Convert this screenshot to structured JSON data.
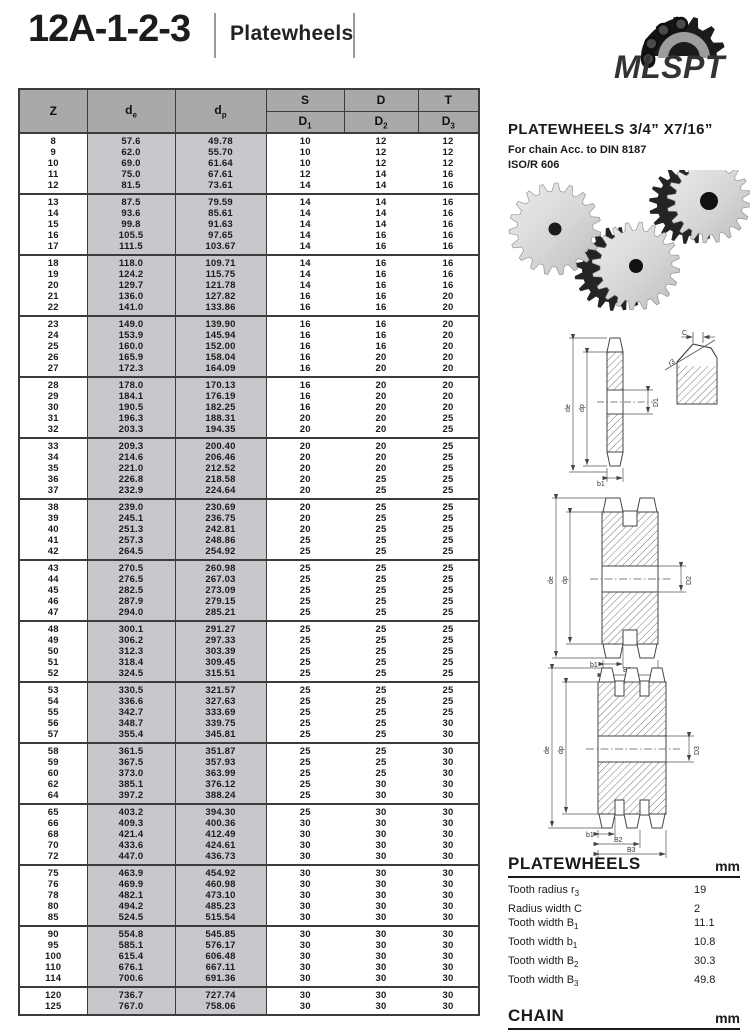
{
  "page": {
    "title": "12A-1-2-3",
    "subtitle": "Platewheels"
  },
  "logo": {
    "text": "MLSPT",
    "color": "#F08233"
  },
  "table": {
    "headers": {
      "z": "Z",
      "de_main": "d",
      "de_sub": "e",
      "dp_main": "d",
      "dp_sub": "p",
      "s": "S",
      "d": "D",
      "t": "T",
      "d1_main": "D",
      "d1_sub": "1",
      "d2_main": "D",
      "d2_sub": "2",
      "d3_main": "D",
      "d3_sub": "3"
    },
    "groups": [
      [
        [
          "8",
          "57.6",
          "49.78",
          "10",
          "12",
          "12"
        ],
        [
          "9",
          "62.0",
          "55.70",
          "10",
          "12",
          "12"
        ],
        [
          "10",
          "69.0",
          "61.64",
          "10",
          "12",
          "12"
        ],
        [
          "11",
          "75.0",
          "67.61",
          "12",
          "14",
          "16"
        ],
        [
          "12",
          "81.5",
          "73.61",
          "14",
          "14",
          "16"
        ]
      ],
      [
        [
          "13",
          "87.5",
          "79.59",
          "14",
          "14",
          "16"
        ],
        [
          "14",
          "93.6",
          "85.61",
          "14",
          "14",
          "16"
        ],
        [
          "15",
          "99.8",
          "91.63",
          "14",
          "14",
          "16"
        ],
        [
          "16",
          "105.5",
          "97.65",
          "14",
          "16",
          "16"
        ],
        [
          "17",
          "111.5",
          "103.67",
          "14",
          "16",
          "16"
        ]
      ],
      [
        [
          "18",
          "118.0",
          "109.71",
          "14",
          "16",
          "16"
        ],
        [
          "19",
          "124.2",
          "115.75",
          "14",
          "16",
          "16"
        ],
        [
          "20",
          "129.7",
          "121.78",
          "14",
          "16",
          "16"
        ],
        [
          "21",
          "136.0",
          "127.82",
          "16",
          "16",
          "20"
        ],
        [
          "22",
          "141.0",
          "133.86",
          "16",
          "16",
          "20"
        ]
      ],
      [
        [
          "23",
          "149.0",
          "139.90",
          "16",
          "16",
          "20"
        ],
        [
          "24",
          "153.9",
          "145.94",
          "16",
          "16",
          "20"
        ],
        [
          "25",
          "160.0",
          "152.00",
          "16",
          "16",
          "20"
        ],
        [
          "26",
          "165.9",
          "158.04",
          "16",
          "20",
          "20"
        ],
        [
          "27",
          "172.3",
          "164.09",
          "16",
          "20",
          "20"
        ]
      ],
      [
        [
          "28",
          "178.0",
          "170.13",
          "16",
          "20",
          "20"
        ],
        [
          "29",
          "184.1",
          "176.19",
          "16",
          "20",
          "20"
        ],
        [
          "30",
          "190.5",
          "182.25",
          "16",
          "20",
          "20"
        ],
        [
          "31",
          "196.3",
          "188.31",
          "20",
          "20",
          "25"
        ],
        [
          "32",
          "203.3",
          "194.35",
          "20",
          "20",
          "25"
        ]
      ],
      [
        [
          "33",
          "209.3",
          "200.40",
          "20",
          "20",
          "25"
        ],
        [
          "34",
          "214.6",
          "206.46",
          "20",
          "20",
          "25"
        ],
        [
          "35",
          "221.0",
          "212.52",
          "20",
          "20",
          "25"
        ],
        [
          "36",
          "226.8",
          "218.58",
          "20",
          "25",
          "25"
        ],
        [
          "37",
          "232.9",
          "224.64",
          "20",
          "25",
          "25"
        ]
      ],
      [
        [
          "38",
          "239.0",
          "230.69",
          "20",
          "25",
          "25"
        ],
        [
          "39",
          "245.1",
          "236.75",
          "20",
          "25",
          "25"
        ],
        [
          "40",
          "251.3",
          "242.81",
          "20",
          "25",
          "25"
        ],
        [
          "41",
          "257.3",
          "248.86",
          "25",
          "25",
          "25"
        ],
        [
          "42",
          "264.5",
          "254.92",
          "25",
          "25",
          "25"
        ]
      ],
      [
        [
          "43",
          "270.5",
          "260.98",
          "25",
          "25",
          "25"
        ],
        [
          "44",
          "276.5",
          "267.03",
          "25",
          "25",
          "25"
        ],
        [
          "45",
          "282.5",
          "273.09",
          "25",
          "25",
          "25"
        ],
        [
          "46",
          "287.9",
          "279.15",
          "25",
          "25",
          "25"
        ],
        [
          "47",
          "294.0",
          "285.21",
          "25",
          "25",
          "25"
        ]
      ],
      [
        [
          "48",
          "300.1",
          "291.27",
          "25",
          "25",
          "25"
        ],
        [
          "49",
          "306.2",
          "297.33",
          "25",
          "25",
          "25"
        ],
        [
          "50",
          "312.3",
          "303.39",
          "25",
          "25",
          "25"
        ],
        [
          "51",
          "318.4",
          "309.45",
          "25",
          "25",
          "25"
        ],
        [
          "52",
          "324.5",
          "315.51",
          "25",
          "25",
          "25"
        ]
      ],
      [
        [
          "53",
          "330.5",
          "321.57",
          "25",
          "25",
          "25"
        ],
        [
          "54",
          "336.6",
          "327.63",
          "25",
          "25",
          "25"
        ],
        [
          "55",
          "342.7",
          "333.69",
          "25",
          "25",
          "25"
        ],
        [
          "56",
          "348.7",
          "339.75",
          "25",
          "25",
          "30"
        ],
        [
          "57",
          "355.4",
          "345.81",
          "25",
          "25",
          "30"
        ]
      ],
      [
        [
          "58",
          "361.5",
          "351.87",
          "25",
          "25",
          "30"
        ],
        [
          "59",
          "367.5",
          "357.93",
          "25",
          "25",
          "30"
        ],
        [
          "60",
          "373.0",
          "363.99",
          "25",
          "25",
          "30"
        ],
        [
          "62",
          "385.1",
          "376.12",
          "25",
          "30",
          "30"
        ],
        [
          "64",
          "397.2",
          "388.24",
          "25",
          "30",
          "30"
        ]
      ],
      [
        [
          "65",
          "403.2",
          "394.30",
          "25",
          "30",
          "30"
        ],
        [
          "66",
          "409.3",
          "400.36",
          "30",
          "30",
          "30"
        ],
        [
          "68",
          "421.4",
          "412.49",
          "30",
          "30",
          "30"
        ],
        [
          "70",
          "433.6",
          "424.61",
          "30",
          "30",
          "30"
        ],
        [
          "72",
          "447.0",
          "436.73",
          "30",
          "30",
          "30"
        ]
      ],
      [
        [
          "75",
          "463.9",
          "454.92",
          "30",
          "30",
          "30"
        ],
        [
          "76",
          "469.9",
          "460.98",
          "30",
          "30",
          "30"
        ],
        [
          "78",
          "482.1",
          "473.10",
          "30",
          "30",
          "30"
        ],
        [
          "80",
          "494.2",
          "485.23",
          "30",
          "30",
          "30"
        ],
        [
          "85",
          "524.5",
          "515.54",
          "30",
          "30",
          "30"
        ]
      ],
      [
        [
          "90",
          "554.8",
          "545.85",
          "30",
          "30",
          "30"
        ],
        [
          "95",
          "585.1",
          "576.17",
          "30",
          "30",
          "30"
        ],
        [
          "100",
          "615.4",
          "606.48",
          "30",
          "30",
          "30"
        ],
        [
          "110",
          "676.1",
          "667.11",
          "30",
          "30",
          "30"
        ],
        [
          "114",
          "700.6",
          "691.36",
          "30",
          "30",
          "30"
        ]
      ],
      [
        [
          "120",
          "736.7",
          "727.74",
          "30",
          "30",
          "30"
        ],
        [
          "125",
          "767.0",
          "758.06",
          "30",
          "30",
          "30"
        ]
      ]
    ]
  },
  "right": {
    "heading": "PLATEWHEELS 3/4” X7/16”",
    "sub1": "For chain Acc. to DIN 8187",
    "sub2": "ISO/R 606",
    "diagrams": {
      "single": {
        "de": "de",
        "dp": "dp",
        "bore": "D1",
        "b1": "b1",
        "c": "C",
        "r3": "r3"
      },
      "duplex": {
        "de": "de",
        "dp": "dp",
        "bore": "D2",
        "b1": "b1",
        "b2": "B2"
      },
      "triplex": {
        "de": "de",
        "dp": "dp",
        "bore": "D3",
        "b1": "b1",
        "b2": "B2",
        "b3": "B3"
      }
    },
    "specs": {
      "platewheels": {
        "title": "PLATEWHEELS",
        "unit": "mm",
        "items": [
          {
            "label": "Tooth radius r",
            "sub": "3",
            "value": "19"
          },
          {
            "label": "Radius width C",
            "sub": "",
            "value": "2"
          },
          {
            "label": "Tooth width B",
            "sub": "1",
            "value": "11.1"
          },
          {
            "label": "Tooth width b",
            "sub": "1",
            "value": "10.8"
          },
          {
            "label": "Tooth width B",
            "sub": "2",
            "value": "30.3"
          },
          {
            "label": "Tooth width B",
            "sub": "3",
            "value": "49.8"
          }
        ]
      },
      "chain": {
        "title": "CHAIN",
        "unit": "mm",
        "items": [
          {
            "label": "Pitch",
            "sub": "",
            "value": "19.05"
          },
          {
            "label": "Internal width",
            "sub": "",
            "value": "11.68"
          },
          {
            "label": "Roller Φ",
            "sub": "",
            "value": "12.07"
          }
        ]
      }
    }
  }
}
